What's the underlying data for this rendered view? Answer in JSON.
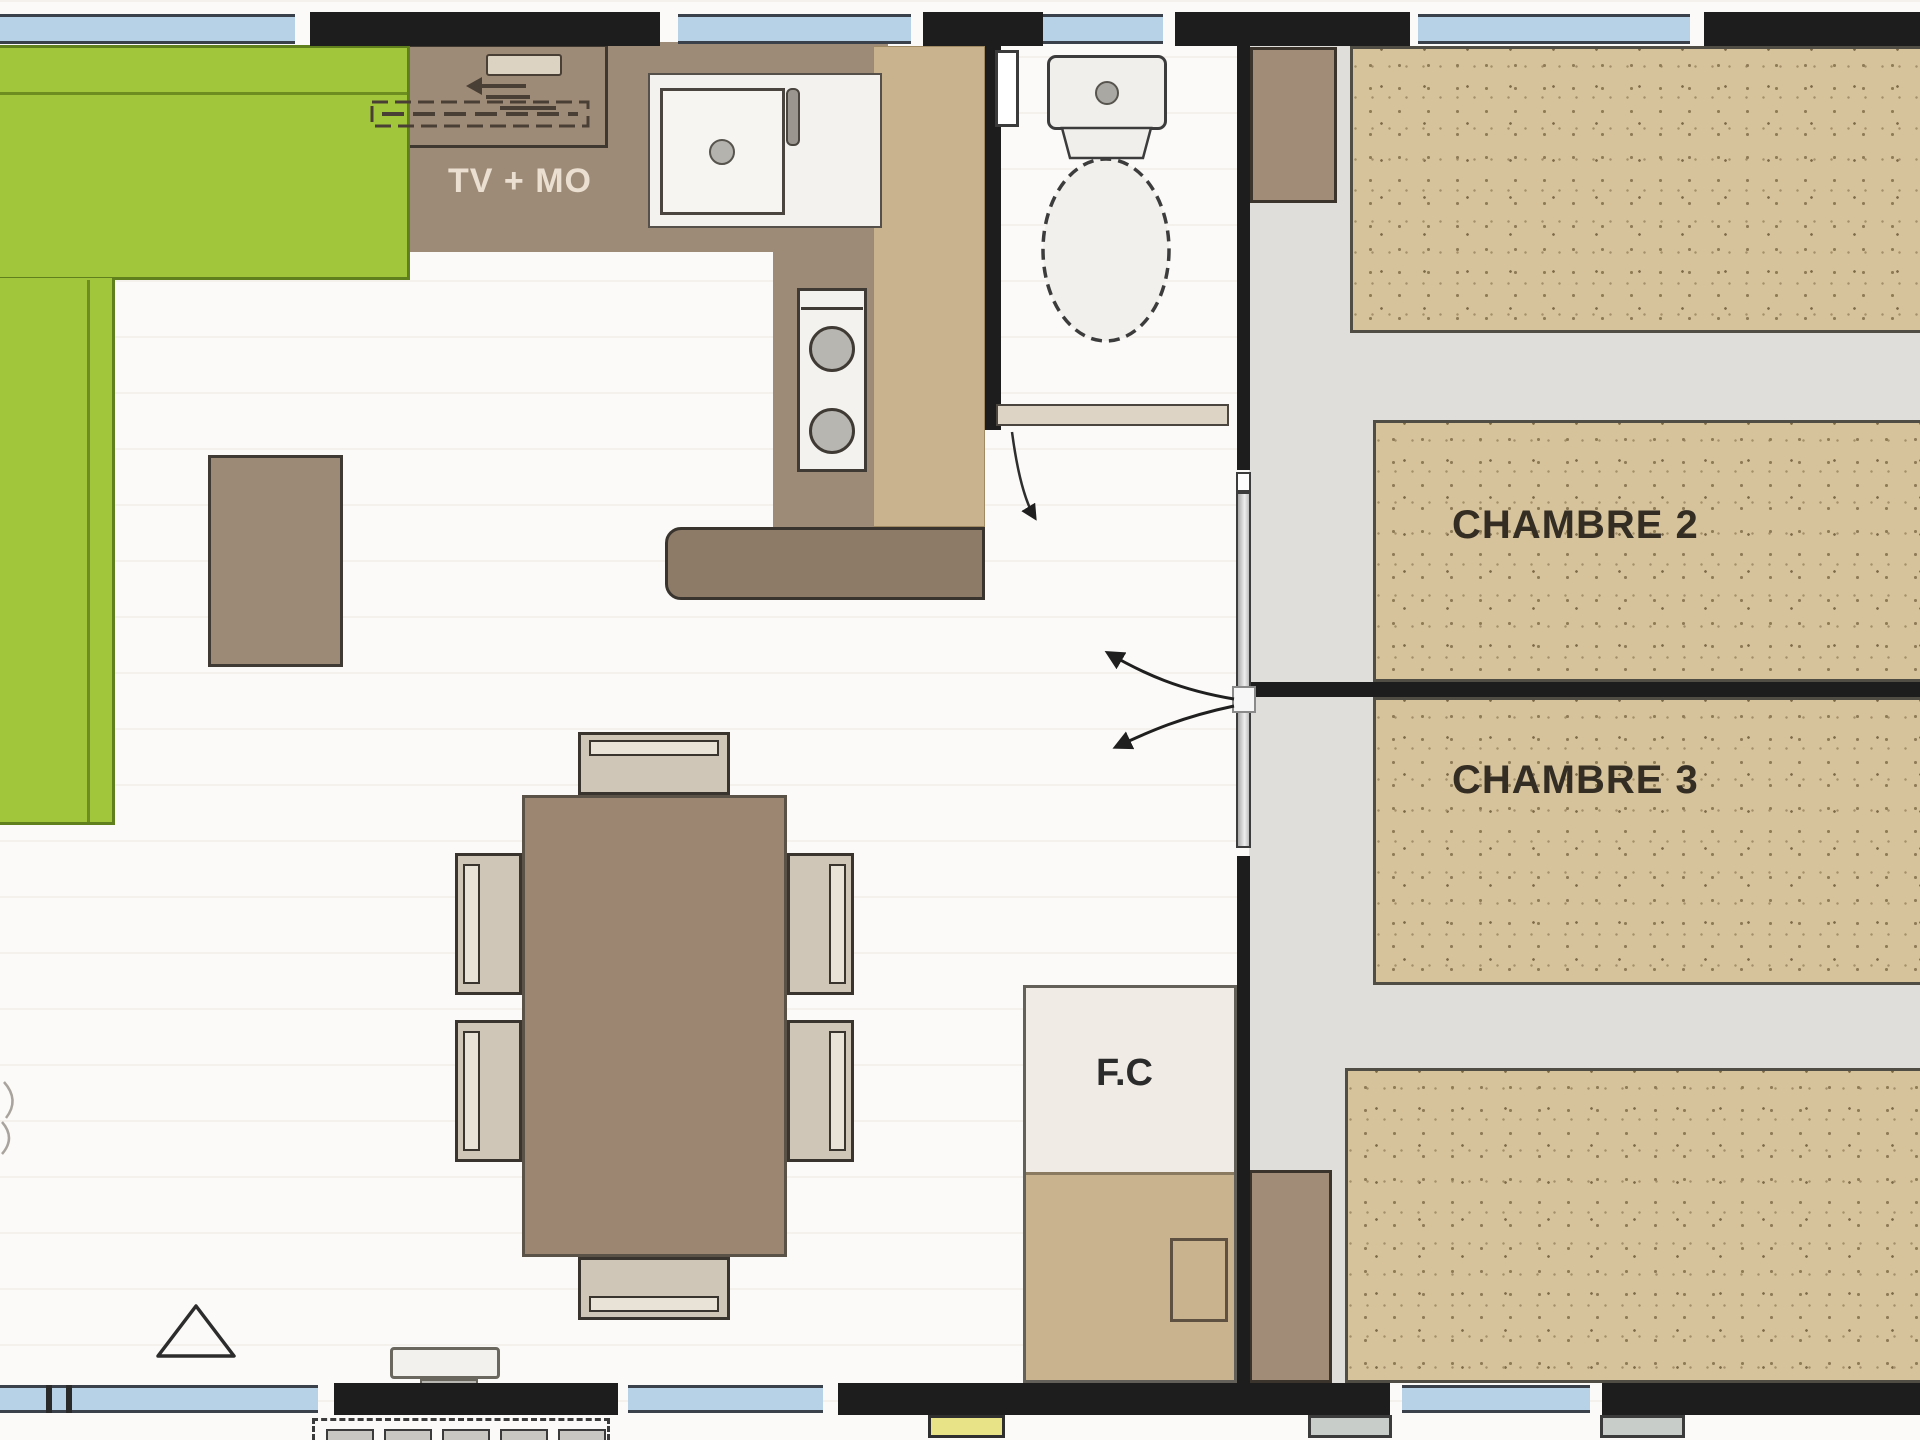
{
  "plan": {
    "room_labels": [
      {
        "id": "tv_unit",
        "text": "TV + MO"
      },
      {
        "id": "bedroom_2",
        "text": "CHAMBRE 2"
      },
      {
        "id": "bedroom_3",
        "text": "CHAMBRE 3"
      },
      {
        "id": "technical_closet",
        "text": "F.C"
      }
    ],
    "colors": {
      "wall": "#1d1d1d",
      "window_glass": "#b7d2e6",
      "sofa_green": "#a2c63b",
      "sofa_green_edge": "#60801e",
      "counter_brown": "#9e8b77",
      "furniture_brown": "#9c8776",
      "bed_tan": "#d6c29b",
      "closet_tan": "#c9b28e",
      "bedroom_floor": "#dfdedb",
      "living_floor": "#fbfaf8",
      "step_yellow": "#e9e387",
      "step_gray": "#c9c7c2",
      "label_dark": "#332d24",
      "label_light": "#eadfd0"
    }
  }
}
